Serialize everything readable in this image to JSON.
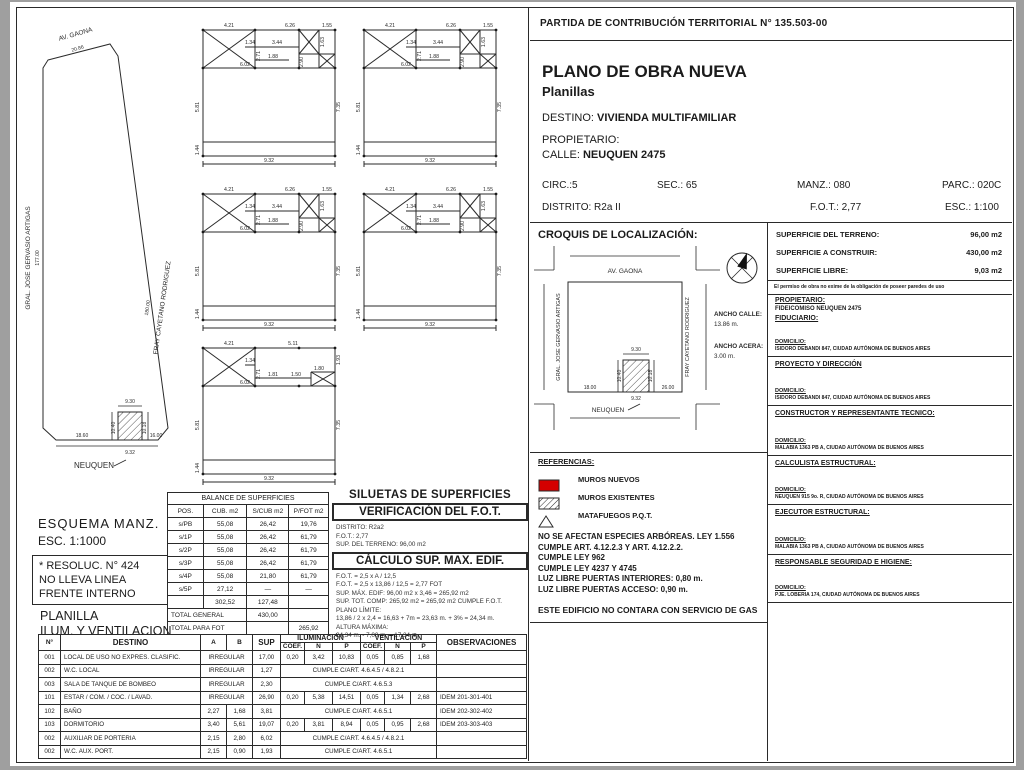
{
  "colors": {
    "accent_red": "#d40000",
    "ink": "#2a2a2a"
  },
  "header": {
    "partida": "PARTIDA DE CONTRIBUCIÓN TERRITORIAL N° 135.503-00",
    "title": "PLANO DE OBRA NUEVA",
    "subtitle": "Planillas",
    "destino_label": "DESTINO:",
    "destino_value": "VIVIENDA MULTIFAMILIAR",
    "propietario_label": "PROPIETARIO:",
    "calle_label": "CALLE:",
    "calle_value": "NEUQUEN 2475",
    "circ": "CIRC.:5",
    "sec": "SEC.: 65",
    "manz": "MANZ.: 080",
    "parc": "PARC.: 020C",
    "distrito": "DISTRITO: R2a II",
    "fot": "F.O.T.: 2,77",
    "esc": "ESC.: 1:100"
  },
  "croquis": {
    "title": "CROQUIS DE LOCALIZACIÓN:",
    "streets": {
      "top": "AV. GAONA",
      "bottom": "NEUQUEN",
      "left": "GRAL. JOSE GERVASIO ARTIGAS",
      "right": "FRAY CAYETANO RODRIGUEZ"
    },
    "parcel_dims": {
      "top": "9.30",
      "left": "10.40",
      "right": "10.18",
      "bottom": "9.32",
      "street_left": "18.00",
      "street_right": "26.00"
    },
    "ancho_calle_label": "ANCHO CALLE:",
    "ancho_calle_value": "13.86 m.",
    "ancho_acera_label": "ANCHO ACERA:",
    "ancho_acera_value": "3.00 m."
  },
  "info_panel": {
    "superficies": [
      {
        "label": "SUPERFICIE DEL TERRENO:",
        "value": "96,00 m2"
      },
      {
        "label": "SUPERFICIE A CONSTRUIR:",
        "value": "430,00 m2"
      },
      {
        "label": "SUPERFICIE LIBRE:",
        "value": "9,03 m2"
      }
    ],
    "disclaimer": "El permiso de obra no exime de la obligación de poseer paredes de uso",
    "sections": [
      {
        "title": "PROPIETARIO:",
        "lines": [
          "FIDEICOMISO NEUQUEN 2475",
          "FIDUCIARIO:"
        ],
        "dom_label": "DOMICILIO:",
        "dom": "ISIDORO DEBANDI 847, CIUDAD AUTÓNOMA DE BUENOS AIRES"
      },
      {
        "title": "PROYECTO Y DIRECCIÓN",
        "lines": [],
        "dom_label": "DOMICILIO:",
        "dom": "ISIDORO DEBANDI 847, CIUDAD AUTÓNOMA DE BUENOS AIRES"
      },
      {
        "title": "CONSTRUCTOR Y REPRESENTANTE TECNICO:",
        "lines": [],
        "dom_label": "DOMICILIO:",
        "dom": "MALABIA 1363 PB A, CIUDAD AUTÓNOMA DE BUENOS AIRES"
      },
      {
        "title": "CALCULISTA ESTRUCTURAL:",
        "lines": [],
        "dom_label": "DOMICILIO:",
        "dom": "NEUQUEN 915 9o. R, CIUDAD AUTÓNOMA DE BUENOS AIRES"
      },
      {
        "title": "EJECUTOR ESTRUCTURAL:",
        "lines": [],
        "dom_label": "DOMICILIO:",
        "dom": "MALABIA 1363 PB A, CIUDAD AUTÓNOMA DE BUENOS AIRES"
      },
      {
        "title": "RESPONSABLE SEGURIDAD E HIGIENE:",
        "lines": [],
        "dom_label": "DOMICILIO:",
        "dom": "PJE. LOBERIA 174, CIUDAD AUTÓNOMA DE BUENOS AIRES"
      }
    ]
  },
  "referencias": {
    "title": "REFERENCIAS:",
    "items": [
      {
        "icon": "red-square",
        "label": "MUROS NUEVOS"
      },
      {
        "icon": "hatched-square",
        "label": "MUROS EXISTENTES"
      },
      {
        "icon": "triangle",
        "label": "MATAFUEGOS P.Q.T."
      }
    ],
    "notes": [
      "NO SE AFECTAN ESPECIES ARBÓREAS. LEY 1.556",
      "CUMPLE ART. 4.12.2.3 Y ART. 4.12.2.2.",
      "CUMPLE LEY 962",
      "CUMPLE LEY 4237 Y 4745",
      "LUZ LIBRE PUERTAS INTERIORES: 0,80 m.",
      "LUZ LIBRE PUERTAS ACCESO: 0,90 m."
    ],
    "footer": "ESTE EDIFICIO NO CONTARA CON SERVICIO DE GAS"
  },
  "esquema": {
    "streets": {
      "top": "AV. GAONA",
      "left": "GRAL. JOSE GERVASIO ARTIGAS",
      "right": "FRAY CAYETANO RODRIGUEZ",
      "bottom": "NEUQUEN"
    },
    "dims": {
      "top": "20.86",
      "left": "177.00",
      "right": "180.00",
      "parcel_top": "9.30",
      "parcel_left": "10.40",
      "parcel_right": "10.18",
      "parcel_bottom": "9.32",
      "bottom_left": "18.60",
      "bottom_right": "16.00"
    },
    "caption1": "ESQUEMA  MANZ.",
    "caption2": "ESC. 1:1000",
    "resoluc_lines": [
      "* RESOLUC. N° 424",
      "NO LLEVA LINEA",
      "FRENTE INTERNO"
    ],
    "planilla_lines": [
      "PLANILLA",
      "ILUM. Y VENTILACION"
    ]
  },
  "balance_table": {
    "title": "BALANCE DE SUPERFICIES",
    "headers": [
      "POS.",
      "CUB. m2",
      "S/CUB m2",
      "P/FOT m2"
    ],
    "rows": [
      [
        "s/PB",
        "55,08",
        "26,42",
        "19,76"
      ],
      [
        "s/1P",
        "55,08",
        "26,42",
        "61,79"
      ],
      [
        "s/2P",
        "55,08",
        "26,42",
        "61,79"
      ],
      [
        "s/3P",
        "55,08",
        "26,42",
        "61,79"
      ],
      [
        "s/4P",
        "55,08",
        "21,80",
        "61,79"
      ],
      [
        "s/5P",
        "27,12",
        "—",
        "—"
      ],
      [
        "",
        "302,52",
        "127,48",
        ""
      ]
    ],
    "total_rows": [
      {
        "label": "TOTAL GENERAL",
        "col": 2,
        "value": "430,00"
      },
      {
        "label": "TOTAL PARA FOT",
        "col": 3,
        "value": "265,92"
      }
    ]
  },
  "siluetas_fot": {
    "title": "SILUETAS DE SUPERFICIES",
    "verificacion_title": "VERIFICACIÓN DEL F.O.T.",
    "verificacion_lines": [
      "DISTRITO: R2a2",
      "F.O.T.: 2,77",
      "SUP. DEL TERRENO: 96,00 m2"
    ],
    "calculo_title": "CÁLCULO SUP. MAX. EDIF.",
    "calculo_lines": [
      "F.O.T. = 2,5 x A / 12,5",
      "F.O.T. = 2,5 x 13,86 / 12,5 = 2,77 FOT",
      "SUP. MÁX. EDIF: 96,00 m2 x 3,46 = 265,92 m2",
      "SUP. TOT. COMP: 265,92 m2 = 265,92 m2 CUMPLE F.O.T.",
      "PLANO LÍMITE:",
      "13,86 / 2 x 2,4 = 16,63 + 7m = 23,63 m. + 3% = 24,34 m.",
      "ALTURA MÁXIMA:",
      "24,34 m. - 7,00 m. = 17,34 m."
    ]
  },
  "planilla_table": {
    "col_headers": {
      "n": "N°",
      "destino": "DESTINO",
      "a": "A",
      "b": "B",
      "sup": "SUP",
      "ilum": "ILUMINACIÓN",
      "vent": "VENTILACIÓN",
      "coef": "COEF.",
      "nn": "N",
      "p": "P",
      "obs": "OBSERVACIONES"
    },
    "rows": [
      {
        "n": "001",
        "destino": "LOCAL DE USO NO EXPRES. CLASIFIC.",
        "ab": "IRREGULAR",
        "sup": "17,00",
        "cells": [
          "0,20",
          "3,42",
          "10,83",
          "0,05",
          "0,85",
          "1,68"
        ],
        "obs": ""
      },
      {
        "n": "002",
        "destino": "W.C. LOCAL",
        "ab": "IRREGULAR",
        "sup": "1,27",
        "merged": "CUMPLE C/ART. 4.6.4.5 / 4.8.2.1",
        "obs": ""
      },
      {
        "n": "003",
        "destino": "SALA DE TANQUE DE BOMBEO",
        "ab": "IRREGULAR",
        "sup": "2,30",
        "merged": "CUMPLE C/ART. 4.6.5.3",
        "obs": ""
      },
      {
        "n": "101",
        "destino": "ESTAR / COM. / COC. / LAVAD.",
        "ab": "IRREGULAR",
        "sup": "26,90",
        "cells": [
          "0,20",
          "5,38",
          "14,51",
          "0,05",
          "1,34",
          "2,68"
        ],
        "obs": "IDEM 201-301-401"
      },
      {
        "n": "102",
        "destino": "BAÑO",
        "a": "2,27",
        "b": "1,68",
        "sup": "3,81",
        "merged": "CUMPLE C/ART. 4.6.5.1",
        "obs": "IDEM 202-302-402"
      },
      {
        "n": "103",
        "destino": "DORMITORIO",
        "a": "3,40",
        "b": "5,61",
        "sup": "19,07",
        "cells": [
          "0,20",
          "3,81",
          "8,94",
          "0,05",
          "0,95",
          "2,68"
        ],
        "obs": "IDEM 203-303-403"
      },
      {
        "n": "002",
        "destino": "AUXILIAR DE PORTERIA",
        "a": "2,15",
        "b": "2,80",
        "sup": "6,02",
        "merged": "CUMPLE C/ART. 4.6.4.5 / 4.8.2.1",
        "obs": ""
      },
      {
        "n": "002",
        "destino": "W.C. AUX. PORT.",
        "a": "2,15",
        "b": "0,90",
        "sup": "1,93",
        "merged": "CUMPLE C/ART. 4.6.5.1",
        "obs": ""
      }
    ]
  },
  "silhouettes": {
    "instances": [
      {
        "variant": "typical",
        "x": 183,
        "y": 12
      },
      {
        "variant": "typical",
        "x": 344,
        "y": 12
      },
      {
        "variant": "typical",
        "x": 183,
        "y": 176
      },
      {
        "variant": "typical",
        "x": 344,
        "y": 176
      },
      {
        "variant": "top",
        "x": 183,
        "y": 330
      }
    ],
    "labels": {
      "typical": [
        {
          "t": "4.21",
          "x": 36,
          "y": 13
        },
        {
          "t": "6.26",
          "x": 97,
          "y": 13
        },
        {
          "t": "1.55",
          "x": 134,
          "y": 13
        },
        {
          "t": "1.34",
          "x": 57,
          "y": 30
        },
        {
          "t": "3.44",
          "x": 84,
          "y": 30
        },
        {
          "t": "2.71",
          "x": 67,
          "y": 42,
          "r": -90
        },
        {
          "t": "1.88",
          "x": 80,
          "y": 44
        },
        {
          "t": "6.02",
          "x": 52,
          "y": 52
        },
        {
          "t": "1.63",
          "x": 131,
          "y": 28,
          "r": -90
        },
        {
          "t": "2.90",
          "x": 110,
          "y": 48,
          "r": -90
        },
        {
          "t": "5.81",
          "x": 6,
          "y": 93,
          "r": -90
        },
        {
          "t": "7.35",
          "x": 147,
          "y": 93,
          "r": -90
        },
        {
          "t": "1.44",
          "x": 6,
          "y": 136,
          "r": -90
        },
        {
          "t": "9.32",
          "x": 76,
          "y": 148
        }
      ],
      "top": [
        {
          "t": "4.21",
          "x": 36,
          "y": 13
        },
        {
          "t": "5.11",
          "x": 100,
          "y": 13
        },
        {
          "t": "1.34",
          "x": 57,
          "y": 30
        },
        {
          "t": "2.71",
          "x": 67,
          "y": 42,
          "r": -90
        },
        {
          "t": "1.81",
          "x": 80,
          "y": 44
        },
        {
          "t": "1.50",
          "x": 103,
          "y": 44
        },
        {
          "t": "1.80",
          "x": 126,
          "y": 38
        },
        {
          "t": "6.02",
          "x": 52,
          "y": 52
        },
        {
          "t": "1.93",
          "x": 147,
          "y": 28,
          "r": -90
        },
        {
          "t": "5.81",
          "x": 6,
          "y": 93,
          "r": -90
        },
        {
          "t": "7.35",
          "x": 147,
          "y": 93,
          "r": -90
        },
        {
          "t": "1.44",
          "x": 6,
          "y": 136,
          "r": -90
        },
        {
          "t": "9.32",
          "x": 76,
          "y": 148
        }
      ]
    }
  }
}
